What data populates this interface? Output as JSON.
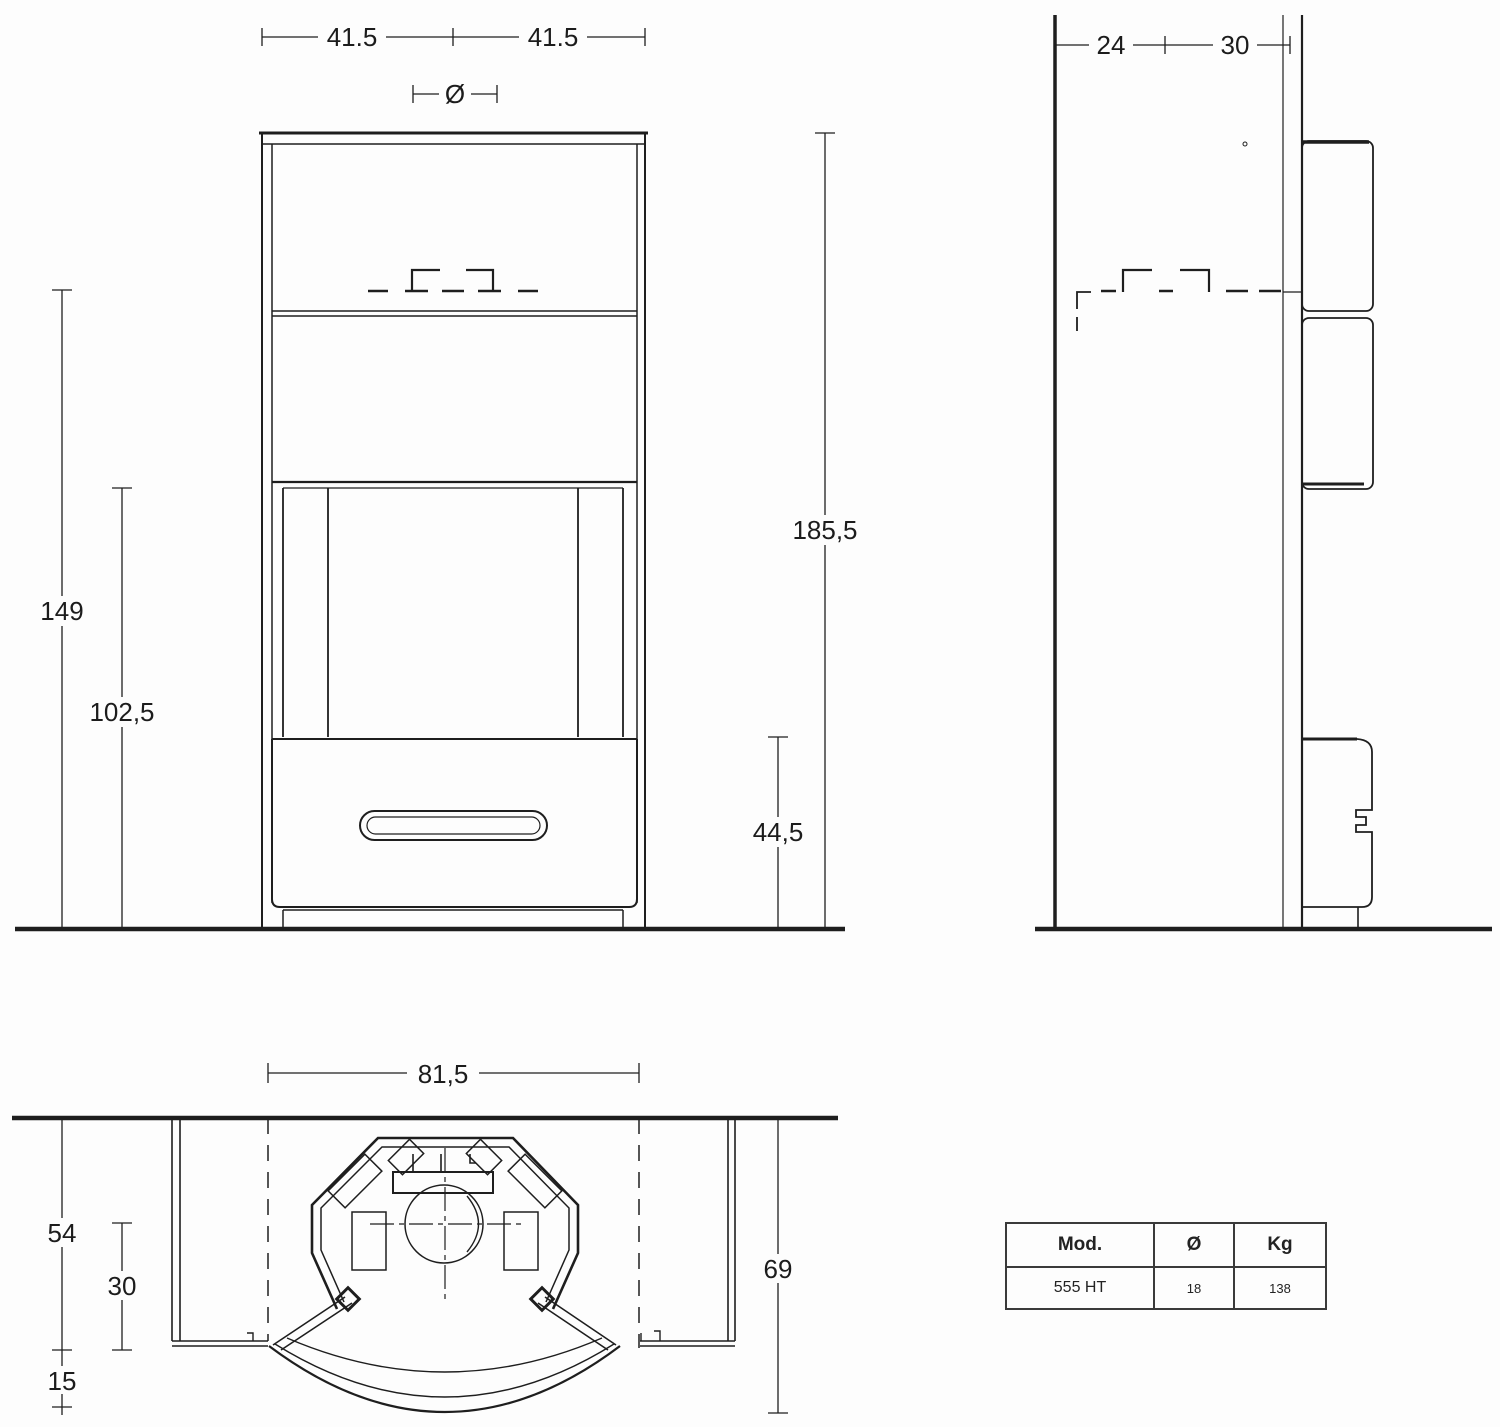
{
  "colors": {
    "line": "#1e1e1e",
    "background": "#fdfdfd"
  },
  "front_view": {
    "dim_top_left": "41.5",
    "dim_top_right": "41.5",
    "flue_diameter_symbol": "Ø",
    "dim_total_height": "185,5",
    "dim_body_height": "149",
    "dim_opening_height": "102,5",
    "dim_base_height": "44,5"
  },
  "side_view": {
    "dim_wall_to_flue": "24",
    "dim_flue_to_front": "30"
  },
  "plan_view": {
    "dim_width": "81,5",
    "dim_side_panel_depth": "54",
    "dim_recess_depth": "30",
    "dim_bow_projection": "15",
    "dim_total_depth": "69"
  },
  "spec_table": {
    "headers": [
      "Mod.",
      "Ø",
      "Kg"
    ],
    "rows": [
      [
        "555 HT",
        "18",
        "138"
      ]
    ]
  }
}
